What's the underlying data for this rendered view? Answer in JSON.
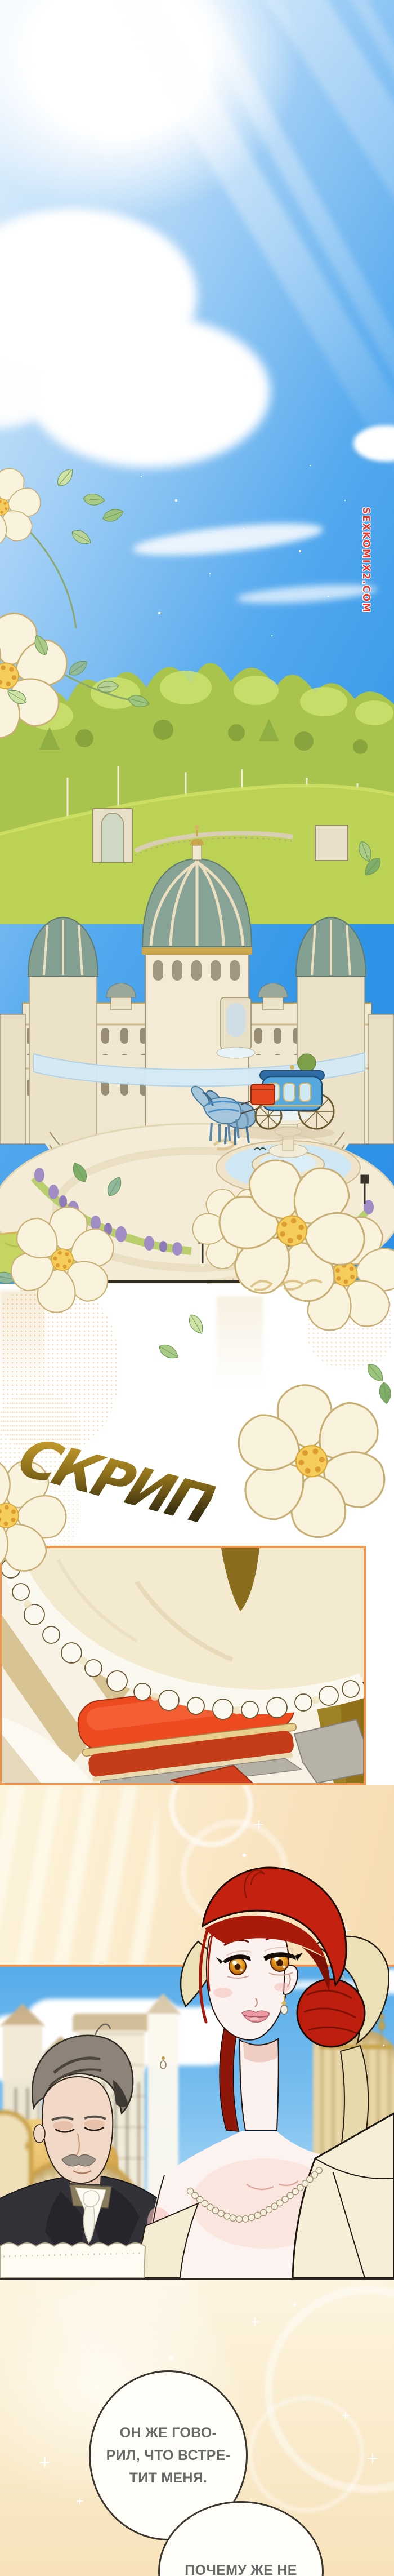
{
  "watermark": {
    "text": "SEXKOMIX2.COM",
    "color": "#e5382b"
  },
  "sfx": {
    "creak": "СКРИП"
  },
  "dialogue": {
    "bubble_1": "ОН ЖЕ ГОВО-\nРИЛ, ЧТО ВСТРЕ-\nТИТ МЕНЯ.",
    "bubble_2": "ПОЧЕМУ ЖЕ НЕ"
  },
  "colors": {
    "sky_azure": "#2e94e8",
    "panel_border_orange": "#f0954e",
    "panel_border_dark": "#2e2a22",
    "footstool_red": "#ee4a20",
    "hair_red": "#c52110",
    "eye_amber": "#f0a826",
    "dome_teal": "#87a396",
    "grass_green": "#bcd255",
    "carriage_blue": "#56a8de",
    "lavender": "#a18cc6",
    "flower_cream": "#f9f3de",
    "flower_center": "#f5cd5c",
    "bubble_text_gray": "#696969",
    "peach_bg": "#f6dcb0"
  }
}
